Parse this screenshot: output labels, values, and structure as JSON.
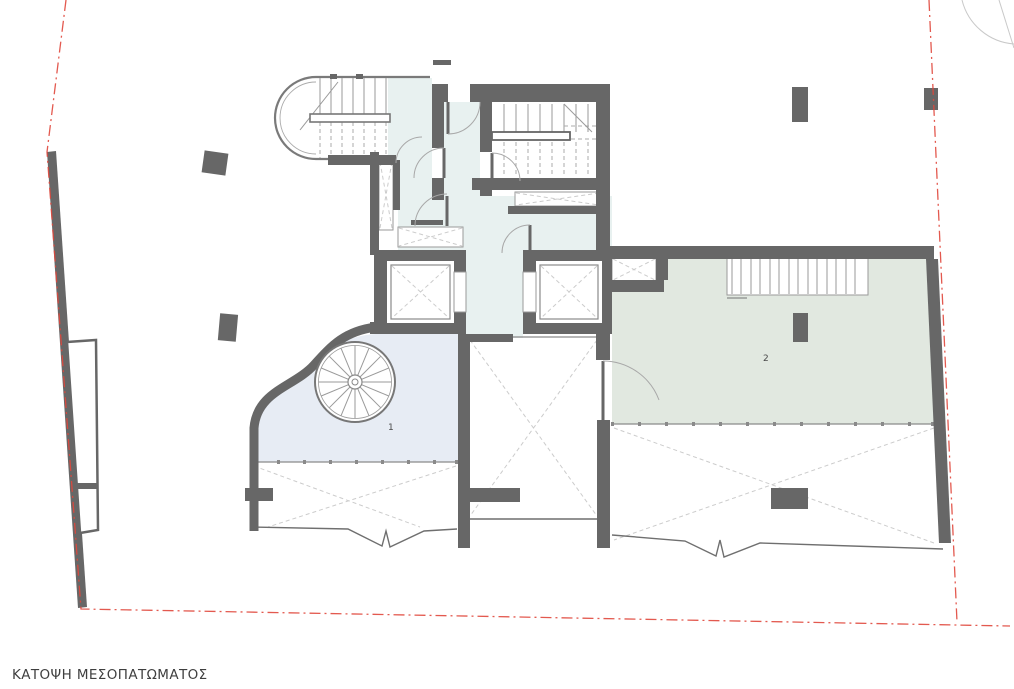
{
  "drawing": {
    "title": "ΚΑΤΟΨΗ ΜΕΣΟΠΑΤΩΜΑΤΟΣ"
  },
  "rooms": [
    {
      "label": "1",
      "floor_color": "#e7ecf4"
    },
    {
      "label": "2",
      "floor_color": "#e1e8e0"
    }
  ],
  "hall": {
    "floor_color": "#e8f1f0"
  },
  "colors": {
    "wall": "#676767",
    "boundary_red": "#e0473c",
    "background": "#ffffff"
  }
}
